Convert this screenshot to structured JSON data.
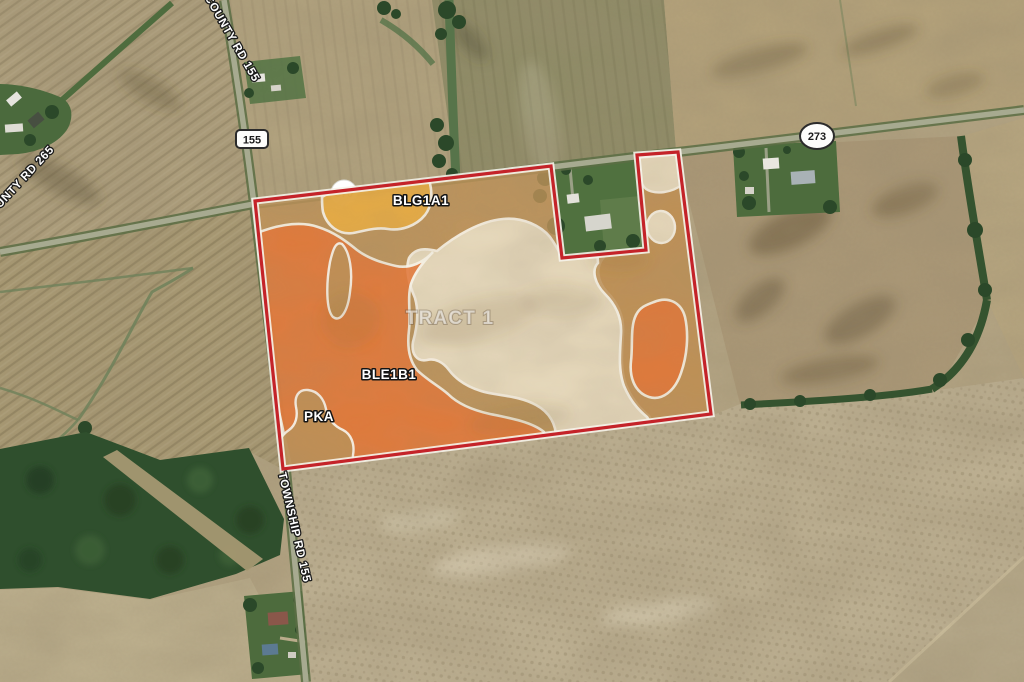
{
  "view": {
    "description": "Satellite farmland view with soil-type overlay highlighting an auction tract"
  },
  "tract": {
    "name": "TRACT 1",
    "border_color": "#c42329"
  },
  "soil_regions": {
    "labels": [
      {
        "code": "BLG1A1"
      },
      {
        "code": "BLE1B1"
      },
      {
        "code": "PKA"
      }
    ],
    "colors": {
      "orange": "#e4783a",
      "cream": "#eadfc6",
      "tan": "#c09156",
      "yellow": "#eaad43",
      "boundary": "#faf6ec"
    }
  },
  "roads": {
    "county_rd_155": "COUNTY RD 155",
    "county_rd_265": "COUNTY RD 265",
    "township_rd_155": "TOWNSHIP RD 155"
  },
  "route_markers": {
    "marker_155": "155",
    "marker_273": "273",
    "marker_370": "370"
  }
}
